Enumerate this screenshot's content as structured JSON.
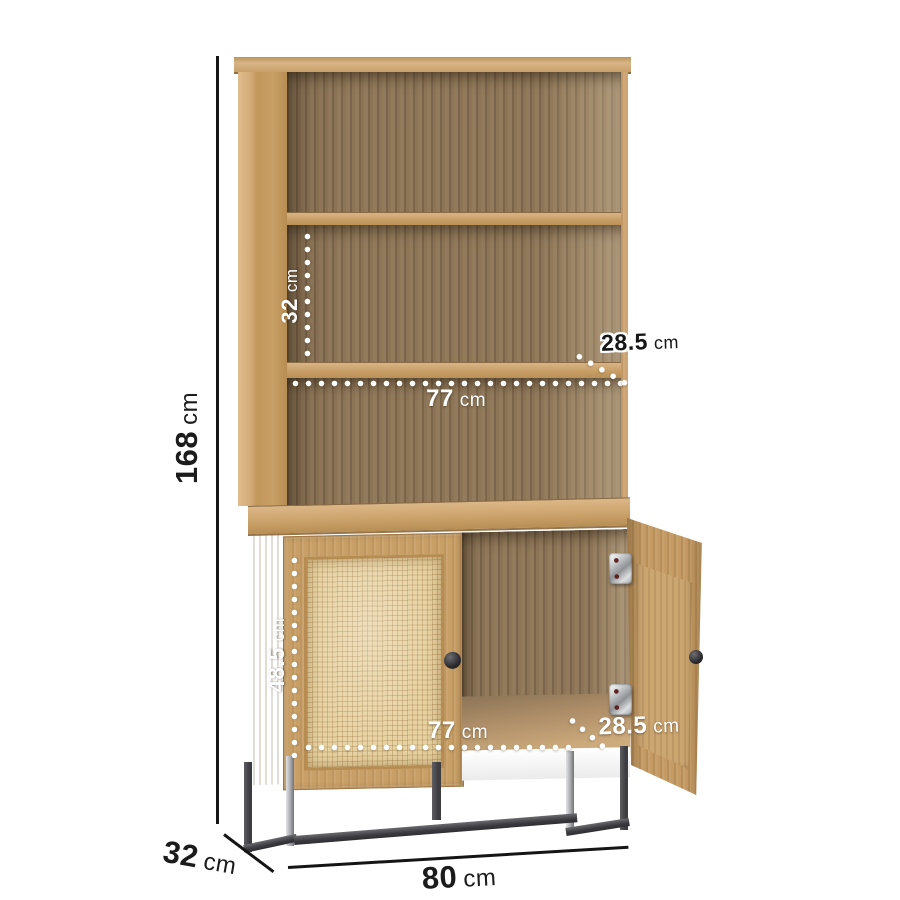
{
  "image": {
    "type": "product-dimension-diagram",
    "product": "Tall oak bookcase with two rattan cabinet doors on a black metal base"
  },
  "dimensions": {
    "overall_height": {
      "value": "168",
      "unit": "cm"
    },
    "overall_depth": {
      "value": "32",
      "unit": "cm"
    },
    "overall_width": {
      "value": "80",
      "unit": "cm"
    },
    "shelf_opening_height": {
      "value": "32",
      "unit": "cm"
    },
    "shelf_depth": {
      "value": "28.5",
      "unit": "cm"
    },
    "shelf_width": {
      "value": "77",
      "unit": "cm"
    },
    "cabinet_opening_height": {
      "value": "48.5",
      "unit": "cm"
    },
    "cabinet_width": {
      "value": "77",
      "unit": "cm"
    },
    "cabinet_depth": {
      "value": "28.5",
      "unit": "cm"
    }
  },
  "colors": {
    "background": "#ffffff",
    "oak_light": "#cfa977",
    "oak_mid": "#c49a63",
    "interior_wood": "#8c7456",
    "rattan": "#e8d2a2",
    "metal_frame": "#47474c",
    "annotation_text": "#1b1b1b",
    "dotted_lines": "#ffffff"
  }
}
